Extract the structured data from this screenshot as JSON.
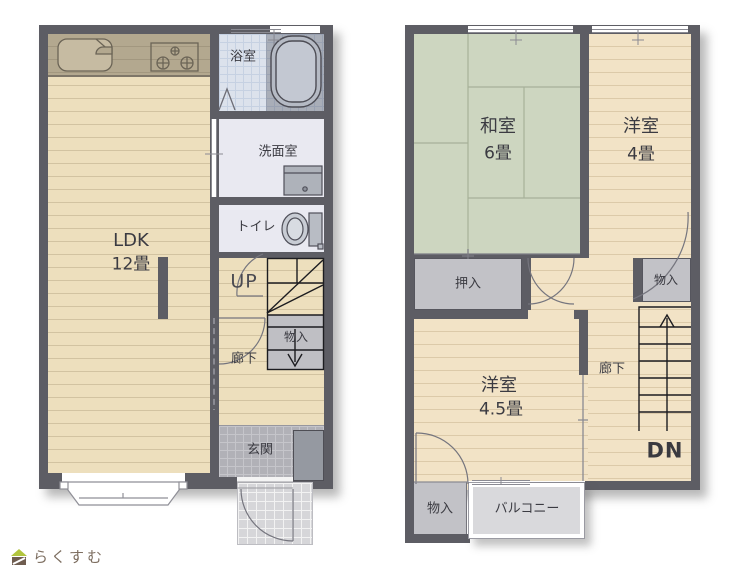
{
  "floor1": {
    "ldk": {
      "name": "LDK",
      "area": "12畳"
    },
    "bathroom": "浴室",
    "washroom": "洗面室",
    "toilet": "トイレ",
    "stairs_up": "UP",
    "hallway": "廊下",
    "stair_storage": "物入",
    "entrance": "玄関"
  },
  "floor2": {
    "japanese_room": {
      "name": "和室",
      "area": "6畳"
    },
    "western_room_4": {
      "name": "洋室",
      "area": "4畳"
    },
    "western_room_45": {
      "name": "洋室",
      "area": "4.5畳"
    },
    "oshiire": "押入",
    "storage_upper": "物入",
    "hallway": "廊下",
    "stairs_down": "DN",
    "storage_lower": "物入",
    "balcony": "バルコニー"
  },
  "logo": {
    "brand": "らくすむ"
  },
  "colors": {
    "wall": "#5d5d64",
    "wood_floor": "#eddfbd",
    "wood_floor_2f": "#f2e3c6",
    "tatami": "#cdd6c0",
    "kitchen_counter": "#b3a88f",
    "bath_tile": "#dce2ec",
    "wet_room": "#e9e9f1",
    "closet_gray": "#c2c2c7",
    "entrance_tile": "#b1b1b7",
    "porch_tile": "#d6d6d9",
    "balcony": "#d9d9dc",
    "logo_roof_green": "#b2c53e",
    "logo_body_brown": "#6f5d50",
    "logo_text_brown": "#7d6e60"
  }
}
